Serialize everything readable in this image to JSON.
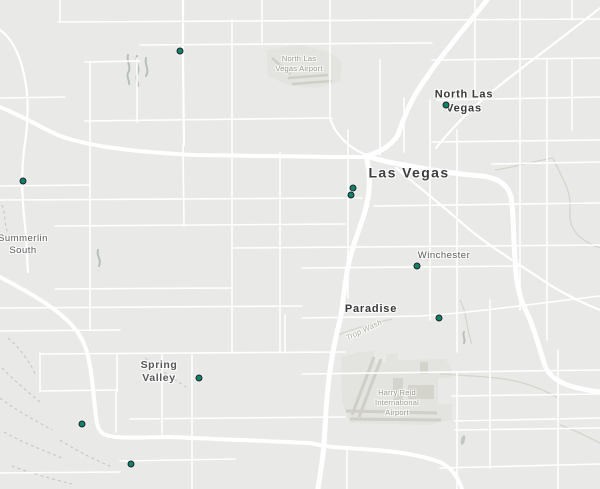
{
  "map": {
    "colors": {
      "land": "#e9e9e7",
      "road": "#ffffff",
      "airport_fill": "#e3e3df",
      "runway": "#cfcfc7",
      "wash": "#d5d5cd",
      "trail": "#c7c7bf",
      "drainage": "#b7bfbe",
      "marker_fill": "#148066",
      "marker_stroke": "#19242c"
    },
    "labels": [
      {
        "id": "north-las-vegas-airport",
        "text": "North Las\nVegas Airport",
        "x": 299,
        "y": 64,
        "type": "poi"
      },
      {
        "id": "north-las-vegas",
        "text": "North Las\nVegas",
        "x": 464,
        "y": 102,
        "type": "city-large"
      },
      {
        "id": "las-vegas",
        "text": "Las Vegas",
        "x": 409,
        "y": 173,
        "type": "city-major"
      },
      {
        "id": "summerlin-south",
        "text": "Summerlin\nSouth",
        "x": 23,
        "y": 245,
        "type": "city-small"
      },
      {
        "id": "winchester",
        "text": "Winchester",
        "x": 444,
        "y": 256,
        "type": "city-small"
      },
      {
        "id": "paradise",
        "text": "Paradise",
        "x": 371,
        "y": 310,
        "type": "city-large"
      },
      {
        "id": "spring-valley",
        "text": "Spring\nValley",
        "x": 159,
        "y": 372,
        "type": "city-medium"
      },
      {
        "id": "harry-reid-international-airport",
        "text": "Harry Reid\nInternational\nAirport",
        "x": 397,
        "y": 403,
        "type": "poi"
      },
      {
        "id": "trop-wash",
        "text": "Trop Wash",
        "x": 364,
        "y": 330,
        "type": "wash-label",
        "rotation": -25
      }
    ],
    "markers": [
      {
        "id": "marker-1",
        "x": 180,
        "y": 51
      },
      {
        "id": "marker-2",
        "x": 446,
        "y": 105
      },
      {
        "id": "marker-3",
        "x": 23,
        "y": 181
      },
      {
        "id": "marker-4",
        "x": 353,
        "y": 188
      },
      {
        "id": "marker-5",
        "x": 351,
        "y": 195
      },
      {
        "id": "marker-6",
        "x": 417,
        "y": 266
      },
      {
        "id": "marker-7",
        "x": 439,
        "y": 318
      },
      {
        "id": "marker-8",
        "x": 199,
        "y": 378
      },
      {
        "id": "marker-9",
        "x": 82,
        "y": 424
      },
      {
        "id": "marker-10",
        "x": 131,
        "y": 464
      }
    ]
  }
}
